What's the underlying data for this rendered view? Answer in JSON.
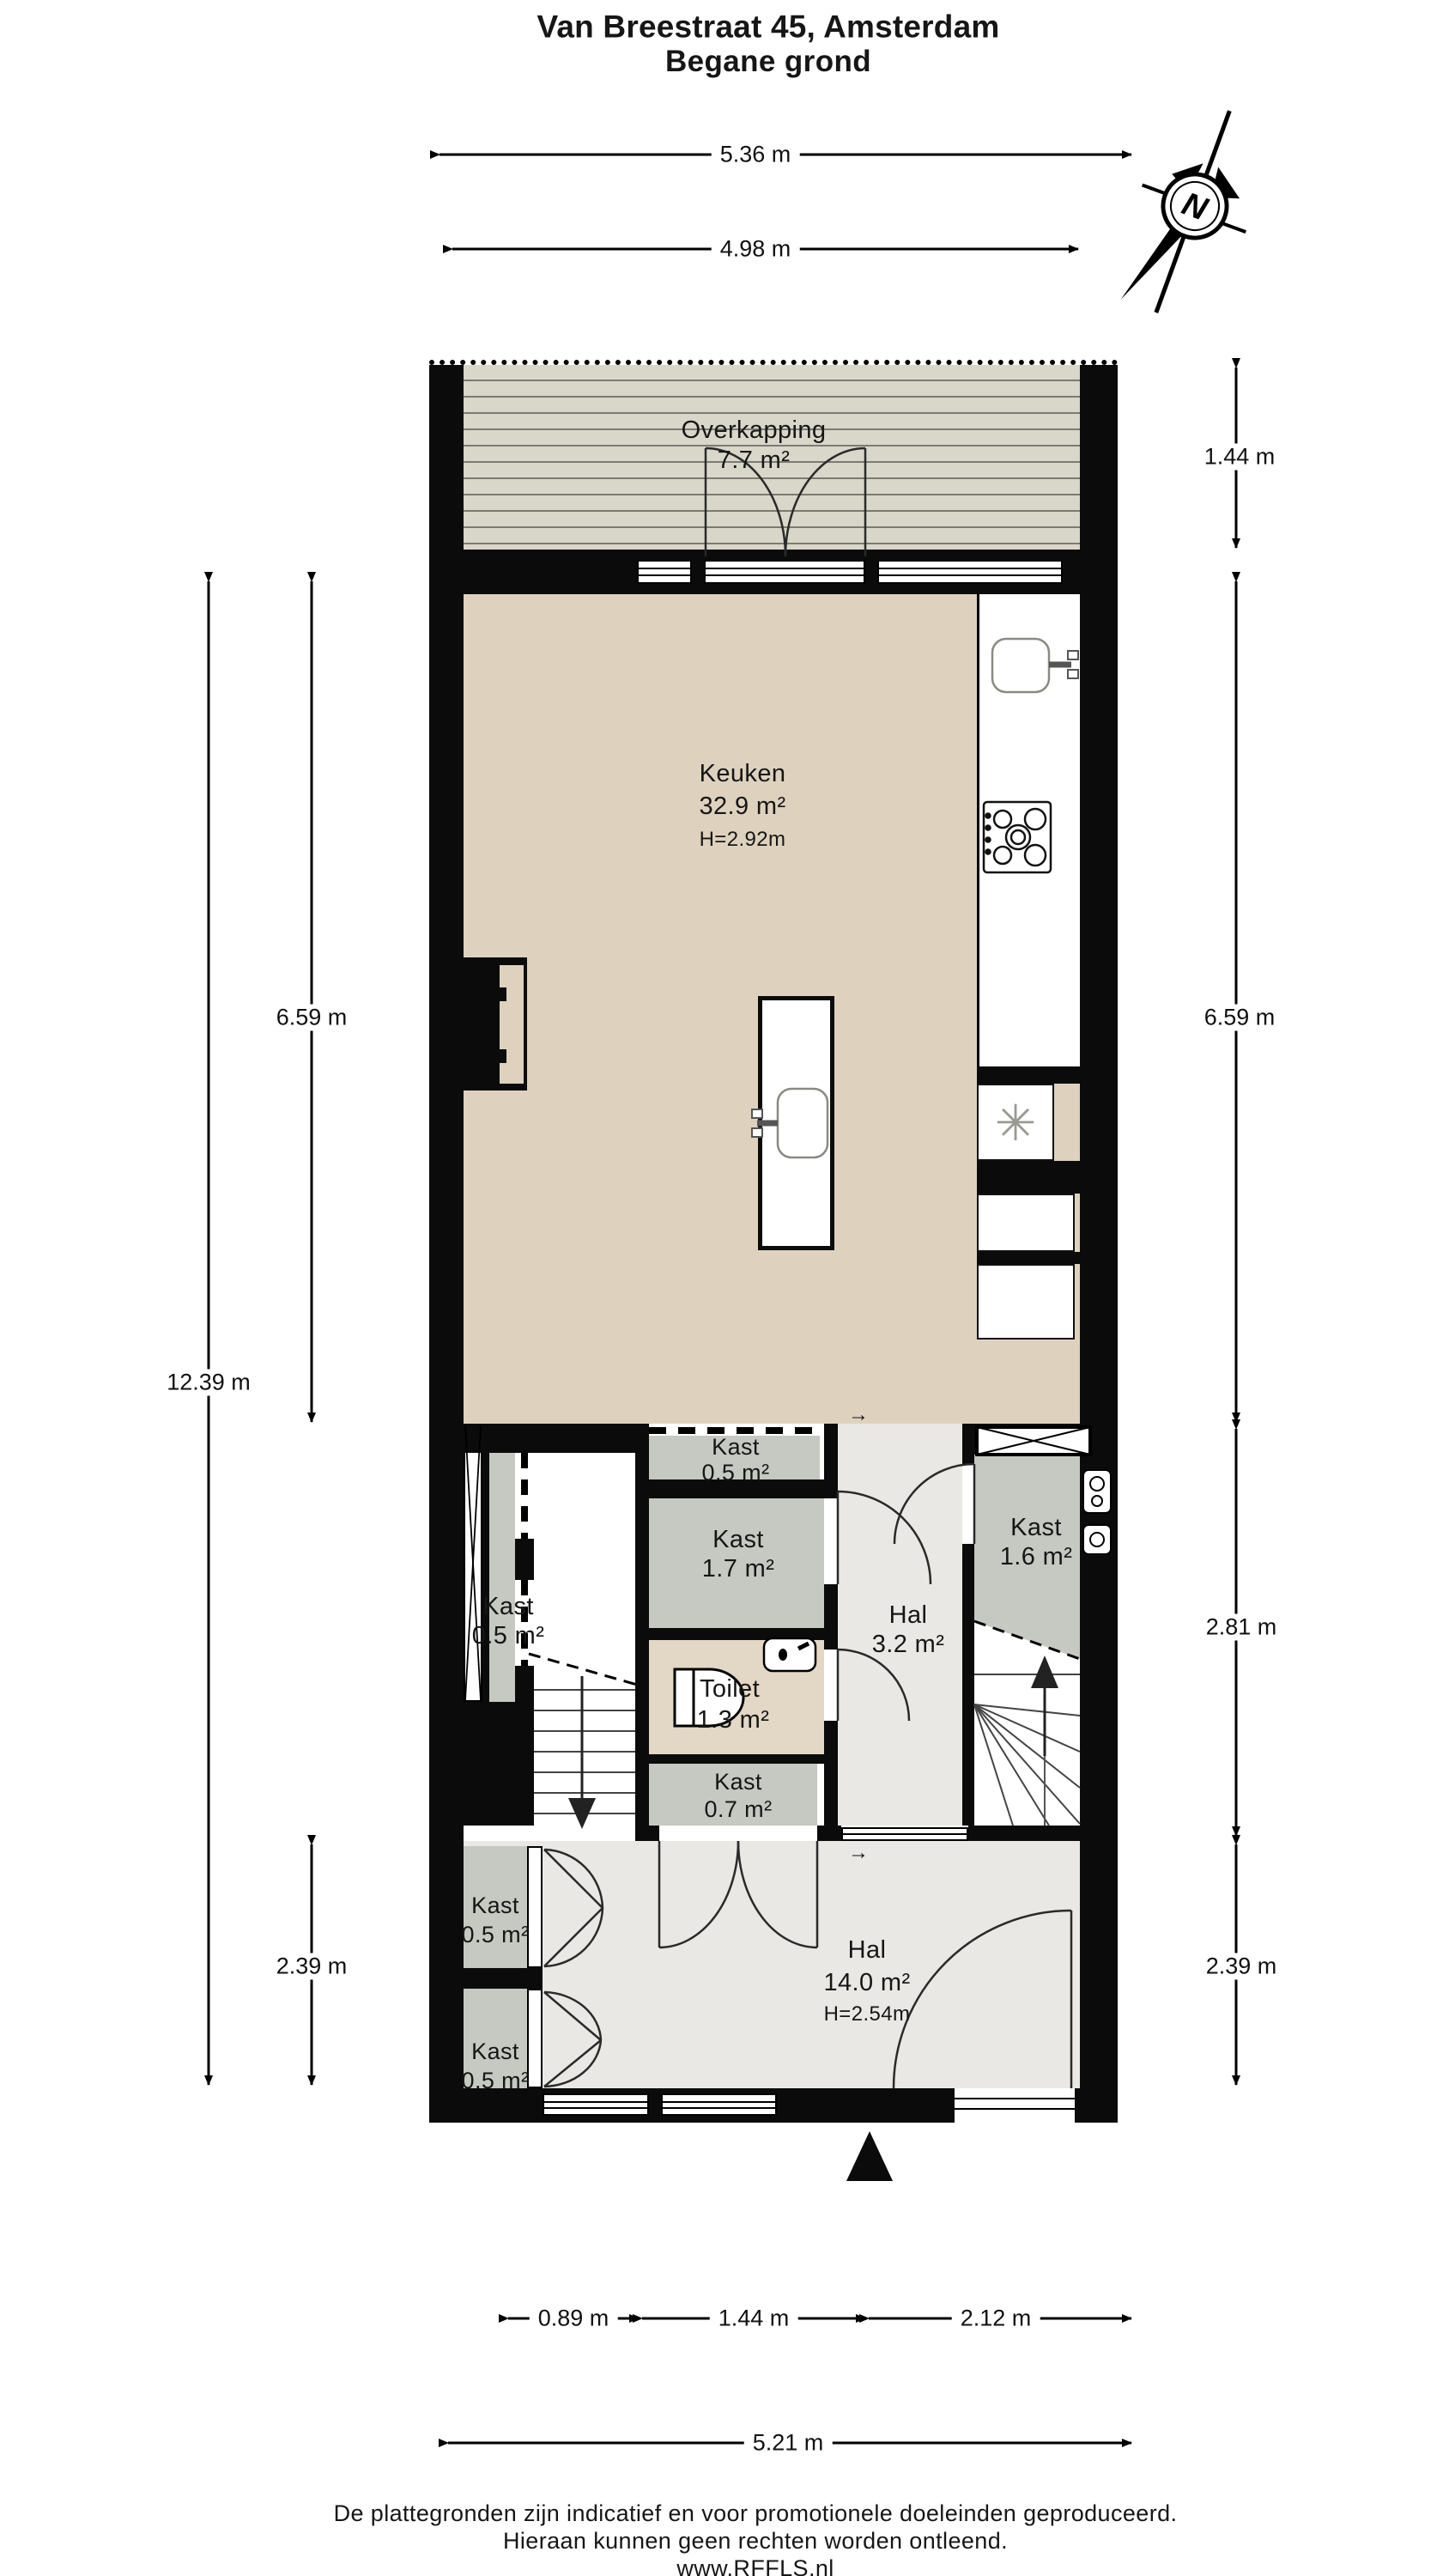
{
  "title": {
    "line1": "Van Breestraat 45, Amsterdam",
    "line2": "Begane grond"
  },
  "compass": {
    "label": "N"
  },
  "dimensions": {
    "top_outer": "5.36 m",
    "top_inner": "4.98 m",
    "right_overkapping": "1.44 m",
    "left_kitchen": "6.59 m",
    "right_kitchen": "6.59 m",
    "left_total": "12.39 m",
    "right_middle": "2.81 m",
    "left_hall": "2.39 m",
    "right_hall": "2.39 m",
    "bottom_seg1": "0.89 m",
    "bottom_seg2": "1.44 m",
    "bottom_seg3": "2.12 m",
    "bottom_total": "5.21 m"
  },
  "rooms": {
    "overkapping": {
      "name": "Overkapping",
      "area": "7.7 m²"
    },
    "keuken": {
      "name": "Keuken",
      "area": "32.9 m²",
      "height": "H=2.92m"
    },
    "kast_top": {
      "name": "Kast",
      "area": "0.5 m²"
    },
    "kast_17": {
      "name": "Kast",
      "area": "1.7 m²"
    },
    "hal_mid": {
      "name": "Hal",
      "area": "3.2 m²"
    },
    "kast_16": {
      "name": "Kast",
      "area": "1.6 m²"
    },
    "kast_left": {
      "name": "Kast",
      "area": "0.5 m²"
    },
    "toilet": {
      "name": "Toilet",
      "area": "1.3 m²"
    },
    "kast_07": {
      "name": "Kast",
      "area": "0.7 m²"
    },
    "kast_b1": {
      "name": "Kast",
      "area": "0.5 m²"
    },
    "kast_b2": {
      "name": "Kast",
      "area": "0.5 m²"
    },
    "hal_main": {
      "name": "Hal",
      "area": "14.0 m²",
      "height": "H=2.54m"
    }
  },
  "misc": {
    "passage_arrow": "→"
  },
  "footer": {
    "line1": "De plattegronden zijn indicatief en voor promotionele doeleinden geproduceerd.",
    "line2": "Hieraan kunnen geen rechten worden ontleend.",
    "line3": "www.RFFLS.nl"
  },
  "colors": {
    "wall": "#0b0b0b",
    "kitchen_floor": "#ded2bf",
    "closet_floor": "#c5c9c1",
    "hall_floor": "#e9e8e4",
    "toilet_floor": "#e3d7c6",
    "deck": "#d9d6ca"
  }
}
